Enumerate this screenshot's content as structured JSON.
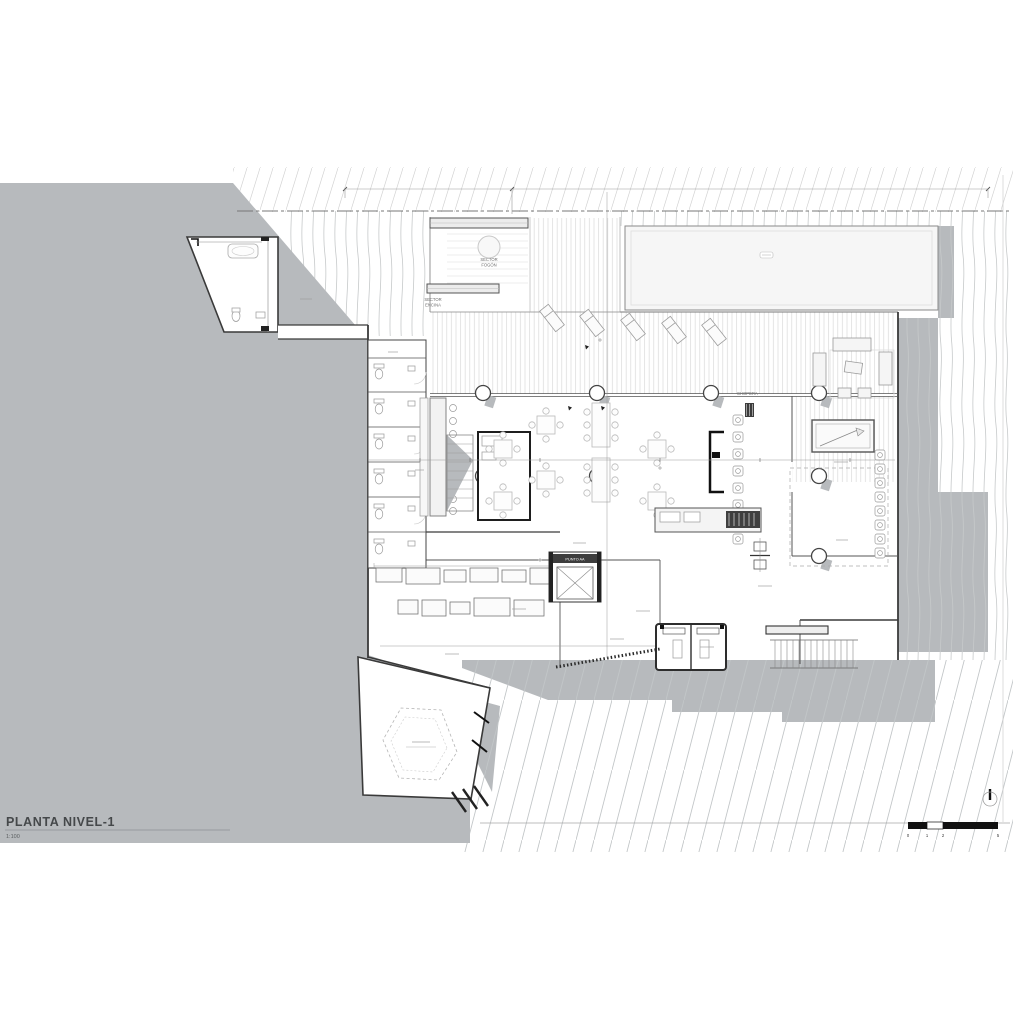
{
  "document": {
    "title": "PLANTA NIVEL-1",
    "scale_note": "1:100"
  },
  "plan": {
    "labels": {
      "sector_fogon_line1": "SECTOR",
      "sector_fogon_line2": "FOGÓN",
      "sector_encina_line1": "SECTOR",
      "sector_encina_line2": "ENCINA",
      "chopera": "CHOPERA",
      "elevator": "PUNTO AA"
    }
  },
  "scale_bar": {
    "ticks": [
      "0",
      "1",
      "2",
      "5"
    ]
  },
  "colors": {
    "paper": "#ffffff",
    "terrain_gray": "#b7babd",
    "contour_light": "#c9cccd",
    "line_dark": "#3a3a3a"
  }
}
